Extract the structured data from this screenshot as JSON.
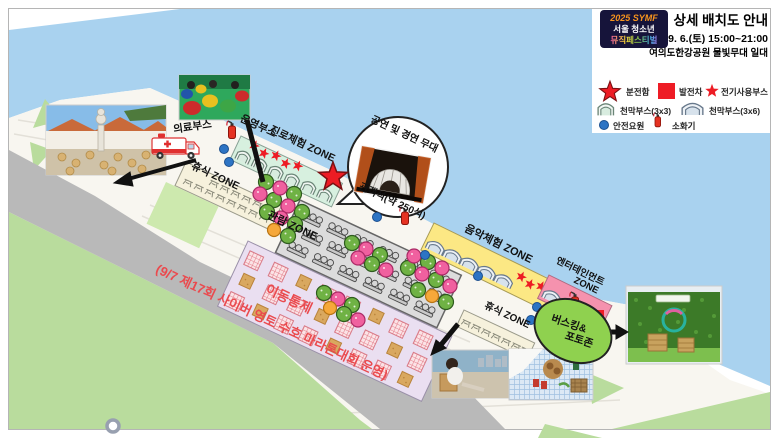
{
  "title_block": {
    "logo": {
      "line1": "2025 SYMF",
      "line2": "서울 청소년",
      "line3": "뮤직페스티벌"
    },
    "title": "상세 배치도 안내",
    "datetime": "9. 6.(토) 15:00~21:00",
    "venue": "여의도한강공원 물빛무대 일대"
  },
  "legend": {
    "items": [
      {
        "icon": "big-star-icon",
        "label": "분전함"
      },
      {
        "icon": "red-square-icon",
        "label": "발전차"
      },
      {
        "icon": "mini-star-icon",
        "label": "전기사용부스"
      },
      {
        "icon": "tent-small-icon",
        "label": "천막부스(3x3)"
      },
      {
        "icon": "tent-large-icon",
        "label": "천막부스(3x6)"
      },
      {
        "icon": "blue-dot-icon",
        "label": "안전요원"
      },
      {
        "icon": "fire-extinguisher-icon",
        "label": "소화기"
      }
    ]
  },
  "map": {
    "zones": {
      "medical": "의료부스",
      "operation": "운영부스",
      "career": "진로체험 ZONE",
      "rest": "휴식 ZONE",
      "viewing": "관람 ZONE",
      "seating": "관객석(약 250석)",
      "stage": "공연 및 경연 무대",
      "music": "음악체험 ZONE",
      "entertainment_line1": "엔터테인먼트",
      "entertainment_line2": "ZONE",
      "busking_line1": "버스킹&",
      "busking_line2": "포토존"
    },
    "notices": {
      "control": "이동통제",
      "marathon": "(9/7 제17회 사이버 영토 수호 마라톤대회 운영)"
    }
  },
  "colors": {
    "river": "#a9d2ef",
    "road": "#b9b9b9",
    "grass": "#b9dc9d",
    "grass_light": "#cde9ae",
    "zone_mint": "#d7f0df",
    "zone_yellow": "#fce884",
    "zone_pink": "#f592ae",
    "zone_purple": "#eadff1",
    "zone_rest": "#f6f1dc",
    "busking_green": "#8fd14f",
    "accent_red": "#ed1c24",
    "notice_red": "#ea4a4e"
  }
}
